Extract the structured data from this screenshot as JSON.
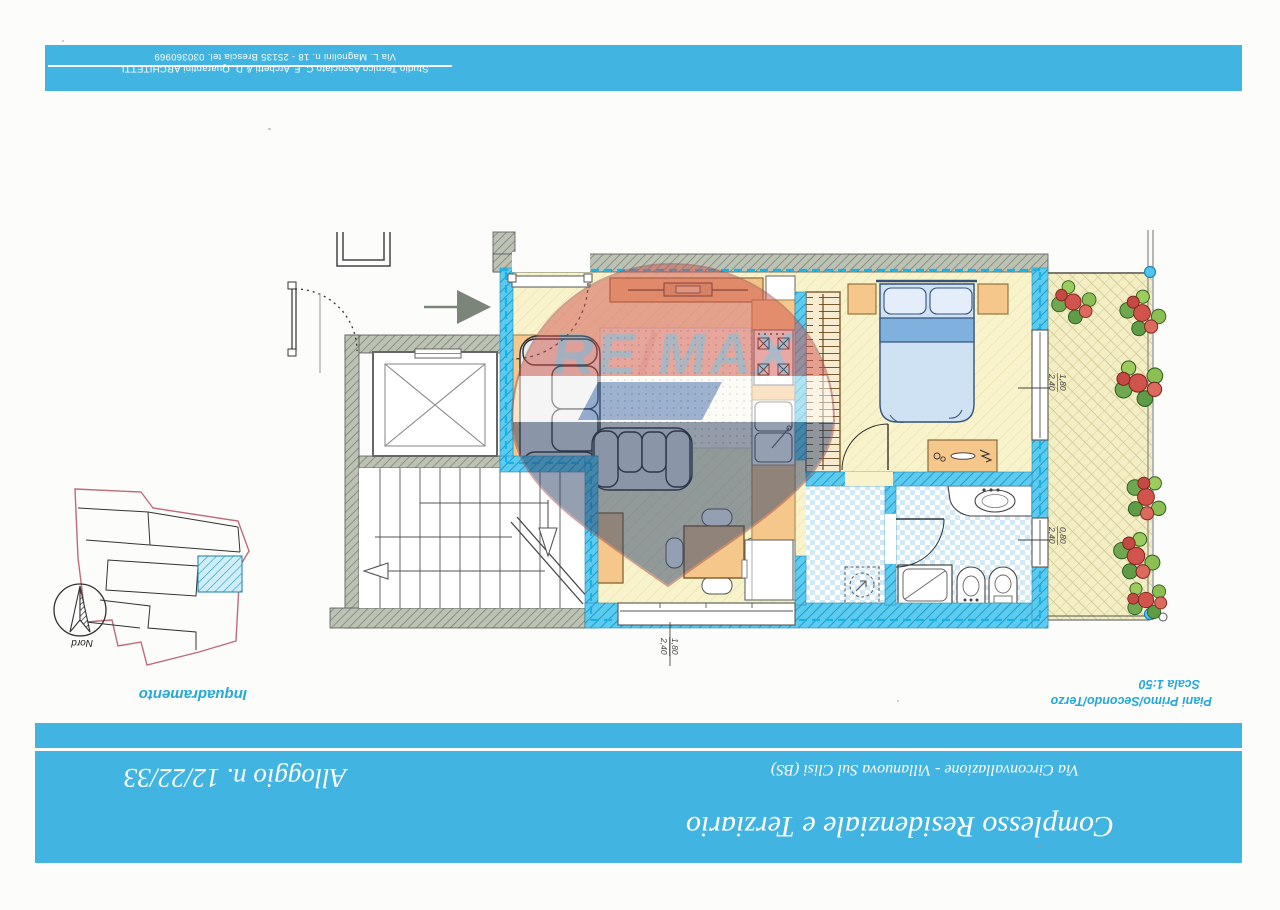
{
  "header": {
    "studio_line": "Studio Tecnico Associato C. F. Archetti & D. Quarantini ARCHITETTI",
    "address_line": "Via L. Magnolini n. 18 - 25135 Brescia tel. 030360969"
  },
  "title_block": {
    "project": "Complesso Residenziale e Terziario",
    "address": "Via Circonvallazione - Villanuova Sul Clisi (BS)",
    "unit": "Alloggio n. 12/22/33"
  },
  "plan": {
    "inset_label": "Inquadramento",
    "floors_label": "Piani Primo/Secondo/Terzo",
    "scale_label": "Scala 1:50",
    "north_label": "Nord",
    "dimensions": {
      "living_window": {
        "w": "1,80",
        "h": "2,40"
      },
      "bedroom_window": {
        "w": "1,80",
        "h": "2,40"
      },
      "bathroom_window": {
        "w": "0,80",
        "h": "2,40"
      }
    }
  },
  "watermark": {
    "re": "RE",
    "slash": "/",
    "max": "MAX"
  },
  "colors": {
    "band": "#41b4e2",
    "wall_cyan": "#5bcbef",
    "wall_gray": "#bcc2b4",
    "floor": "#f8f3cb",
    "balloon_red": "#d2544e",
    "balloon_navy": "#2e4168",
    "label_cyan": "#25a8da"
  }
}
